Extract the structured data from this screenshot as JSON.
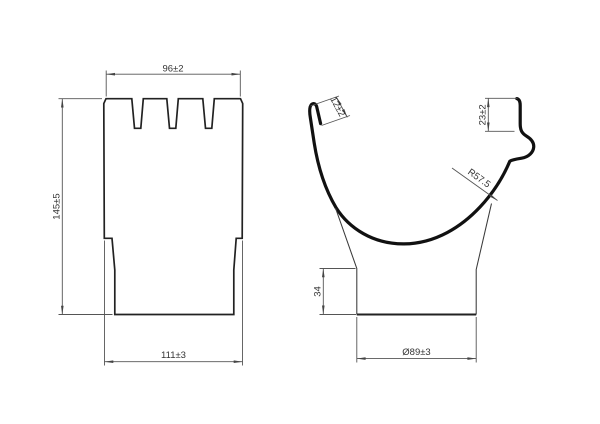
{
  "colors": {
    "background": "#ffffff",
    "profile_line": "#111111",
    "outline_line": "#222222",
    "dimension_line": "#555555",
    "text": "#333333"
  },
  "front_view": {
    "dim_top_width": "96±2",
    "dim_height": "145±5",
    "dim_bottom_width": "111±3"
  },
  "side_view": {
    "dim_hook_fold": "12±2",
    "dim_rear_edge_height": "23±2",
    "dim_radius": "R57.5",
    "dim_outlet_height": "34",
    "dim_outlet_diameter": "Ø89±3"
  }
}
